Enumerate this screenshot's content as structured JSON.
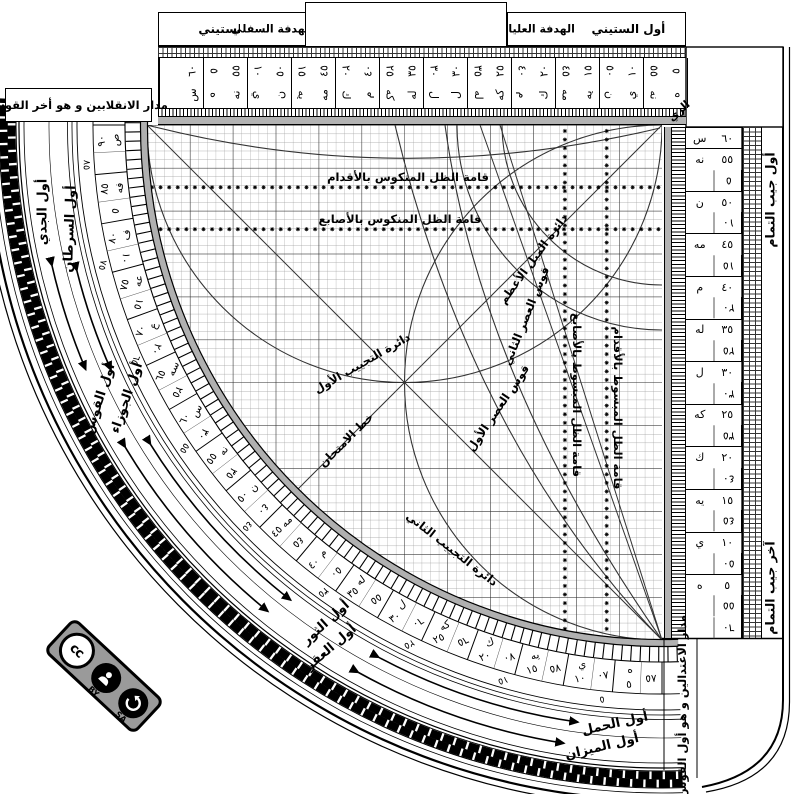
{
  "title_boxes": {
    "sixty_start": "أول الستيني",
    "sixty_end": "أخر الستيني",
    "upper_sight": "الهدفة العليا",
    "lower_sight": "الهدفة السفلي",
    "solstice_line": "مدار الانقلابين و هو أخر القوس",
    "equinox_line": "مدار الاعتدالين و هو أول القوس",
    "cosine_start": "أول جيب التمام",
    "cosine_end": "آخر جيب التمام",
    "corner_inscription": "الزي"
  },
  "grid_labels": {
    "reversed_shadow_feet": "قامة الظل المنكوس بالأقدام",
    "reversed_shadow_digits": "قامة الظل المنكوس بالأصابع",
    "extended_shadow_digits": "قامة الظل المبسوط بالأصابع",
    "extended_shadow_feet": "قامة الظل المبسوط بالأقدام",
    "max_declination": "دائرة الميل الأعظم",
    "first_sine_circle": "دائرة التجييب الأول",
    "second_sine_circle": "دائرة التجييب الثاني",
    "first_asr_arc": "قوس العصر الأول",
    "second_asr_arc": "قوس العصر الثاني",
    "test_line": "خط الامتحان"
  },
  "zodiac": {
    "inner": [
      "أول السرطان",
      "أول الجوزاء",
      "أول الثور",
      "أول الحمل"
    ],
    "outer": [
      "أول الجدي",
      "أول القوس",
      "أول العقرب",
      "أول الميزان"
    ]
  },
  "scales": {
    "arc_main_abjad": [
      "ص",
      "فه",
      "ف",
      "عه",
      "ع",
      "سه",
      "س",
      "نه",
      "ن",
      "مه",
      "م",
      "له",
      "ل",
      "كه",
      "ك",
      "يه",
      "ي",
      "ه"
    ],
    "arc_main_indic": [
      "٩٠",
      "٨٥",
      "٨٠",
      "٧٥",
      "٧٠",
      "٦٥",
      "٦٠",
      "٥٥",
      "٥٠",
      "٤٥",
      "٤٠",
      "٣٥",
      "٣٠",
      "٢٥",
      "٢٠",
      "١٥",
      "١٠",
      "٥"
    ],
    "arc_complement_indic": [
      "٥",
      "١٠",
      "١٥",
      "٢٠",
      "٢٥",
      "٣٠",
      "٣٥",
      "٤٠",
      "٤٥",
      "٥٠",
      "٥٥",
      "٦٠",
      "٦٥",
      "٧٠",
      "٧٥",
      "٨٠",
      "٨٥"
    ],
    "arc_inner_ring": [
      "٨٥",
      "٧٥",
      "٦٥",
      "٥٥",
      "٤٥",
      "٣٥",
      "٢٥",
      "١٥",
      "٥"
    ],
    "top_main_indic": [
      "٥",
      "١٠",
      "١٥",
      "٢٠",
      "٢٥",
      "٣٠",
      "٣٥",
      "٤٠",
      "٤٥",
      "٥٠",
      "٥٥",
      "٦٠"
    ],
    "top_main_abjad": [
      "ه",
      "ي",
      "يه",
      "ك",
      "كه",
      "ل",
      "له",
      "م",
      "مه",
      "ن",
      "نه",
      "س"
    ],
    "top_comp_indic": [
      "٥٥",
      "٥٠",
      "٤٥",
      "٤٠",
      "٣٥",
      "٣٠",
      "٢٥",
      "٢٠",
      "١٥",
      "١٠",
      "٥",
      ""
    ],
    "top_comp_abjad": [
      "نه",
      "ن",
      "مه",
      "م",
      "له",
      "ل",
      "كه",
      "ك",
      "يه",
      "ي",
      "ه",
      ""
    ],
    "right_main_abjad": [
      "س",
      "نه",
      "ن",
      "مه",
      "م",
      "له",
      "ل",
      "كه",
      "ك",
      "يه",
      "ي",
      "ه"
    ],
    "right_main_indic": [
      "٦٠",
      "٥٥",
      "٥٠",
      "٤٥",
      "٤٠",
      "٣٥",
      "٣٠",
      "٢٥",
      "٢٠",
      "١٥",
      "١٠",
      "٥"
    ],
    "right_comp_indic": [
      "٥",
      "١٠",
      "١٥",
      "٢٠",
      "٢٥",
      "٣٠",
      "٣٥",
      "٤٠",
      "٤٥",
      "٥٠",
      "٥٥",
      "٦٠"
    ]
  },
  "license": {
    "by": "BY",
    "sa": "SA",
    "cc": "cc"
  }
}
